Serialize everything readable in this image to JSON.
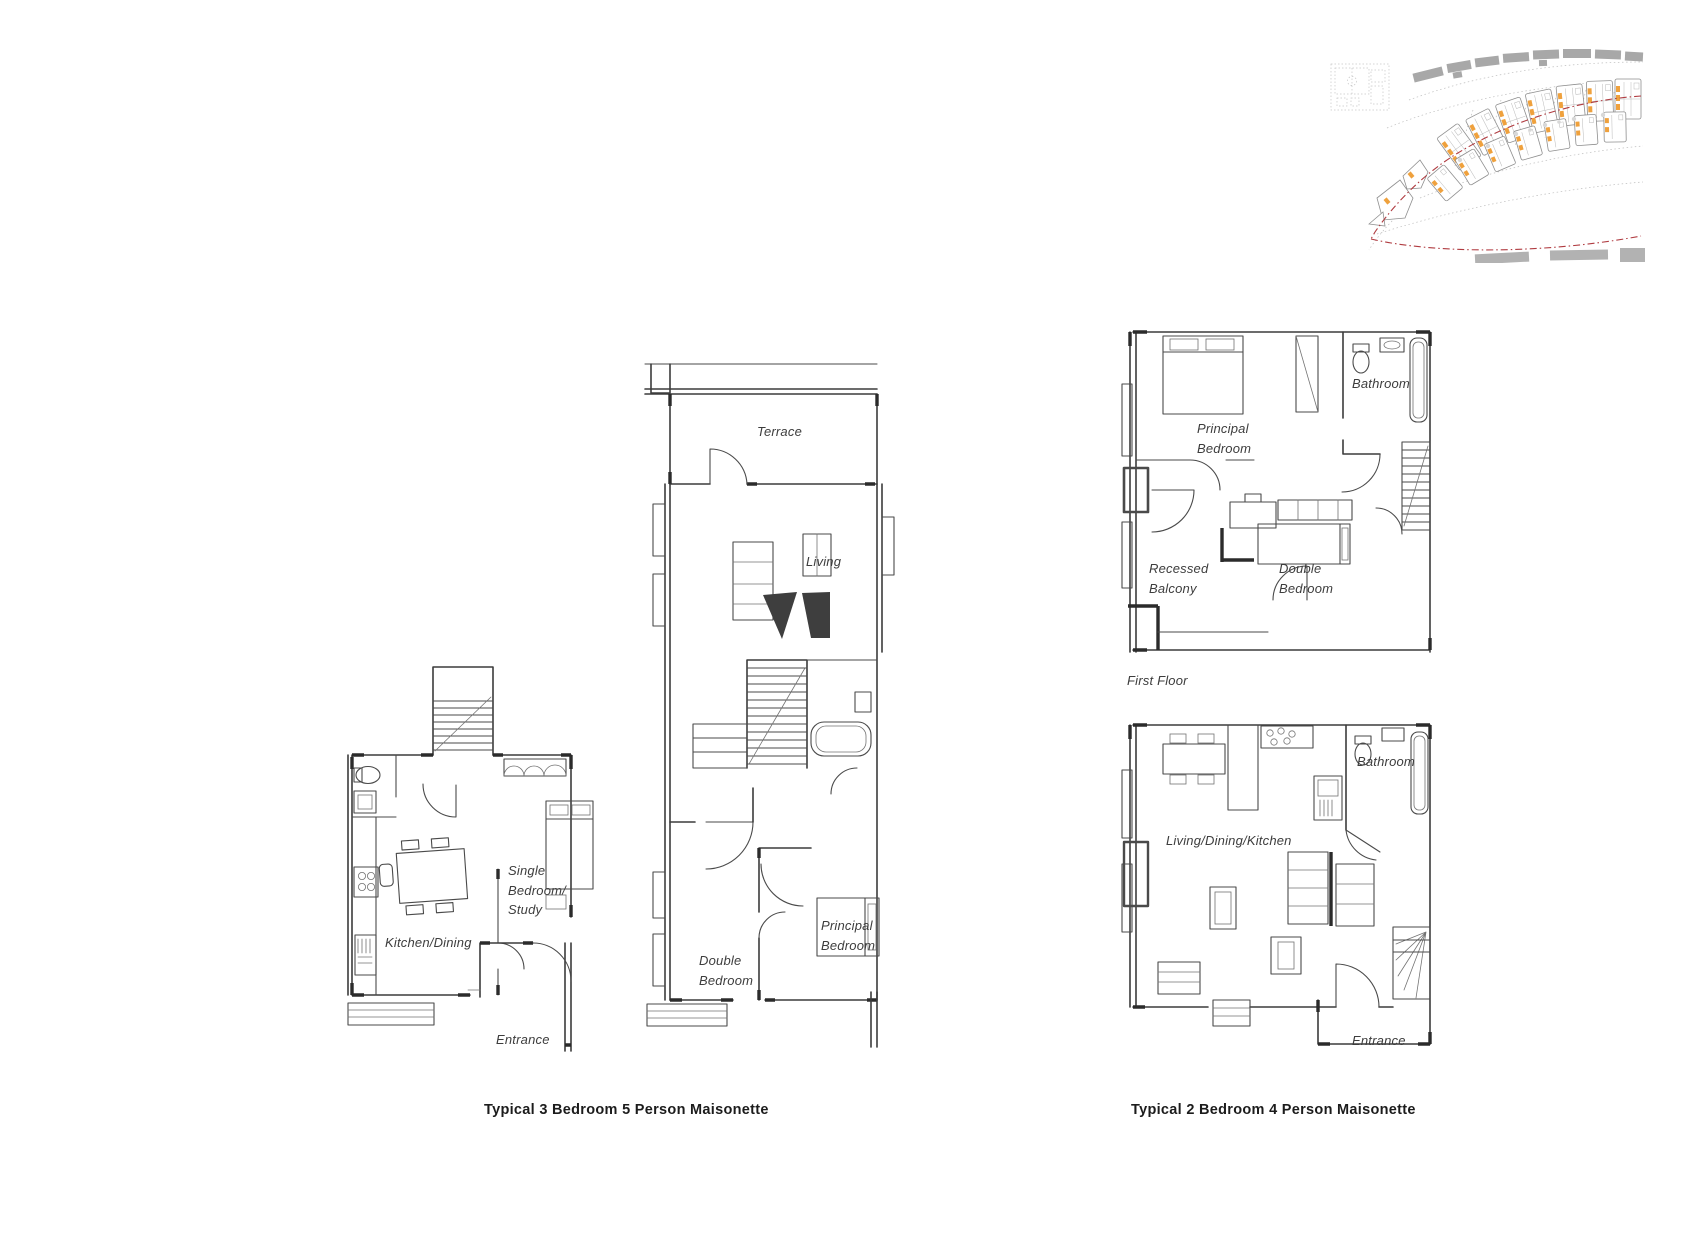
{
  "sheet": {
    "background": "#ffffff",
    "colors": {
      "sketch_line": "#4a4a4a",
      "label_text": "#3d3d3d",
      "caption_text": "#1c1c1c",
      "map_building_gray": "#a8a8a8",
      "map_unit_orange": "#efa13d",
      "map_boundary_red": "#b03b40"
    }
  },
  "plans": {
    "three_bed": {
      "caption": "Typical 3 Bedroom 5 Person Maisonette",
      "lower_floor": {
        "kitchen_dining": "Kitchen/Dining",
        "single_bedroom_study": "Single\nBedroom/\nStudy",
        "entrance": "Entrance"
      },
      "upper_floor": {
        "terrace": "Terrace",
        "living": "Living",
        "double_bedroom": "Double\nBedroom",
        "principal_bedroom": "Principal\nBedroom"
      }
    },
    "two_bed": {
      "caption": "Typical 2 Bedroom 4 Person Maisonette",
      "first_floor": {
        "floor_label": "First Floor",
        "principal_bedroom": "Principal\nBedroom",
        "bathroom": "Bathroom",
        "recessed_balcony": "Recessed\nBalcony",
        "double_bedroom": "Double\nBedroom"
      },
      "ground_floor": {
        "living_dining_kitchen": "Living/Dining/Kitchen",
        "bathroom": "Bathroom",
        "entrance": "Entrance"
      }
    }
  }
}
